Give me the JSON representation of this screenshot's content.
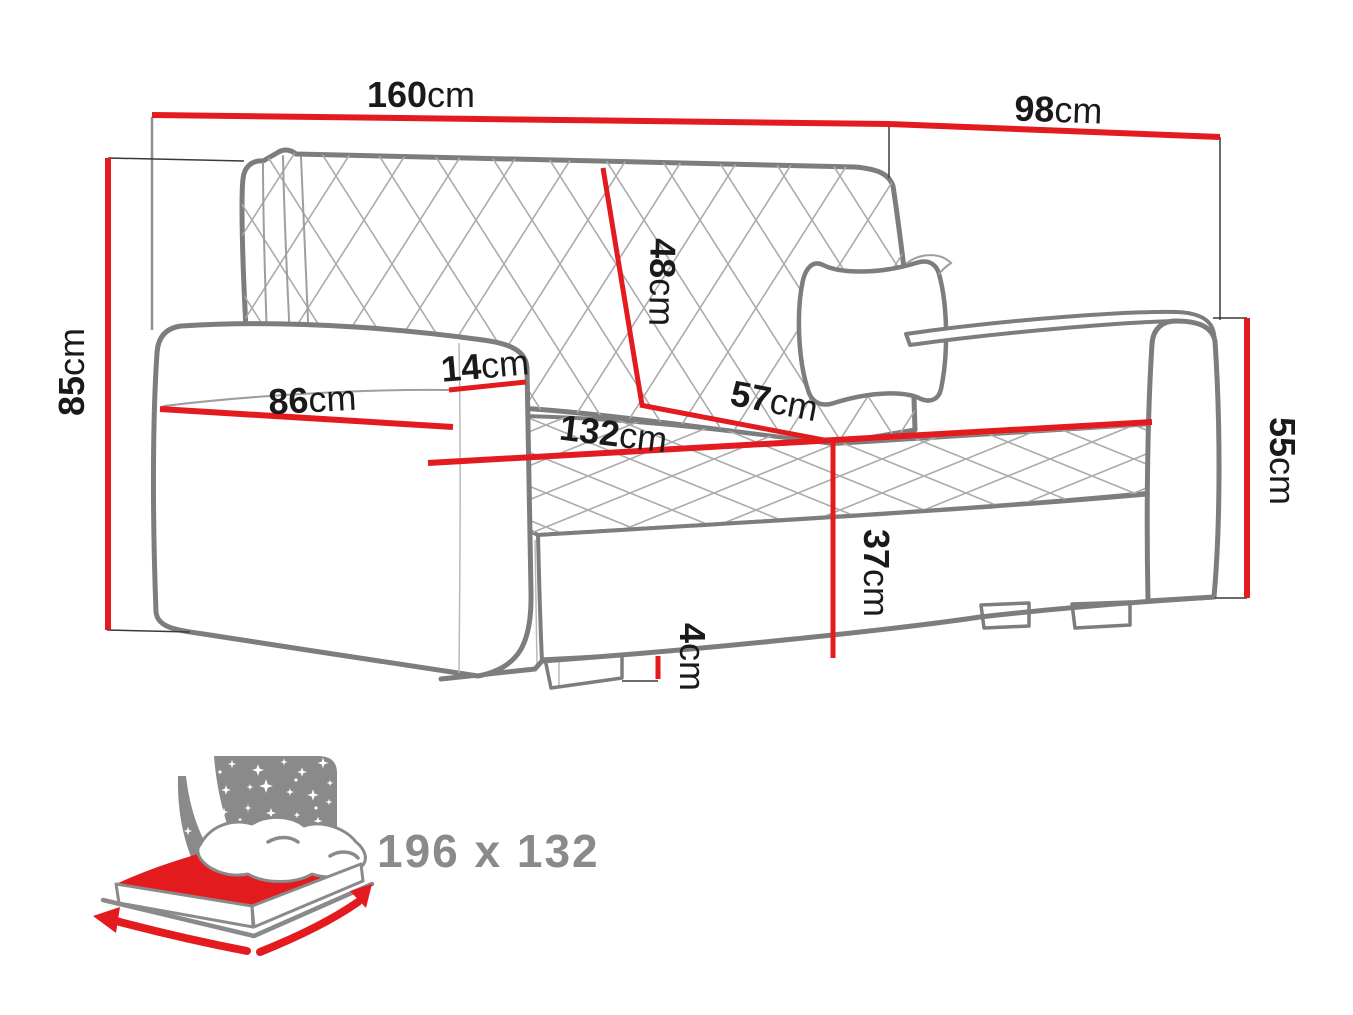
{
  "colors": {
    "dimension_red": "#e31b1f",
    "outline_gray": "#7d7d7d",
    "quilt_gray": "#ababab",
    "icon_gray": "#8a8a8a",
    "text_black": "#1a1a1a"
  },
  "dimensions": {
    "overall_width": {
      "value": "160",
      "unit": "cm"
    },
    "overall_depth": {
      "value": "98",
      "unit": "cm"
    },
    "overall_height": {
      "value": "85",
      "unit": "cm"
    },
    "backrest_height": {
      "value": "48",
      "unit": "cm"
    },
    "armrest_width": {
      "value": "14",
      "unit": "cm"
    },
    "side_depth": {
      "value": "86",
      "unit": "cm"
    },
    "seat_depth": {
      "value": "57",
      "unit": "cm"
    },
    "seat_width": {
      "value": "132",
      "unit": "cm"
    },
    "seat_height": {
      "value": "55",
      "unit": "cm"
    },
    "base_height": {
      "value": "37",
      "unit": "cm"
    },
    "leg_height": {
      "value": "4",
      "unit": "cm"
    }
  },
  "sleeping_area": {
    "label": "196 x 132"
  },
  "icons": {
    "sleep_function": "bed-with-night-sky-icon"
  }
}
